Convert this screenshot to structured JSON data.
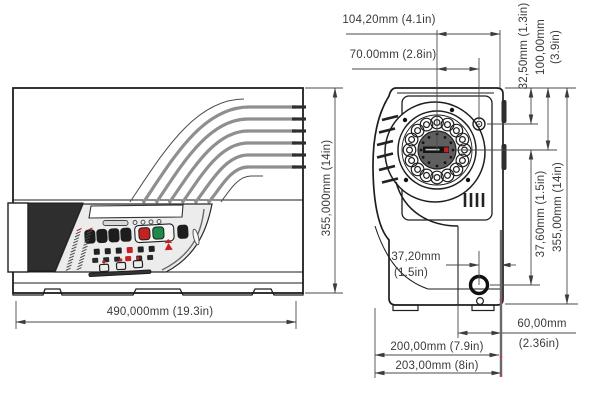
{
  "drawing": {
    "description": "Two-view dimensioned technical drawing of benchtop rotor instrument",
    "colors": {
      "line": "#1e1e1e",
      "dimension_line": "#4a4a4a",
      "accent_red": "#c42222",
      "accent_green": "#1d8a4a",
      "panel_grey": "#ececec",
      "rotor_disk_grey": "#5f5f5f",
      "snap_marker_pink": "#d6336c"
    },
    "dims": {
      "top_outer": "104,20mm (4.1in)",
      "top_inner": "70.00mm (2.8in)",
      "right_top_first": "32,50mm (1.3in)",
      "right_top_second_mm": "100,00mm",
      "right_top_second_in": "(3.9in)",
      "front_height": "355,000mm (14in)",
      "side_height": "355,00mm (14in)",
      "side_mid": "37,60mm (1.5in)",
      "front_width": "490,000mm (19.3in)",
      "port_inset_mm": "37,20mm",
      "port_inset_in": "(1.5in)",
      "rear_offset_mm": "60,00mm",
      "rear_offset_in": "(2.36in)",
      "depth_body": "200,00mm (7.9in)",
      "depth_total": "203,00mm (8in)"
    }
  }
}
